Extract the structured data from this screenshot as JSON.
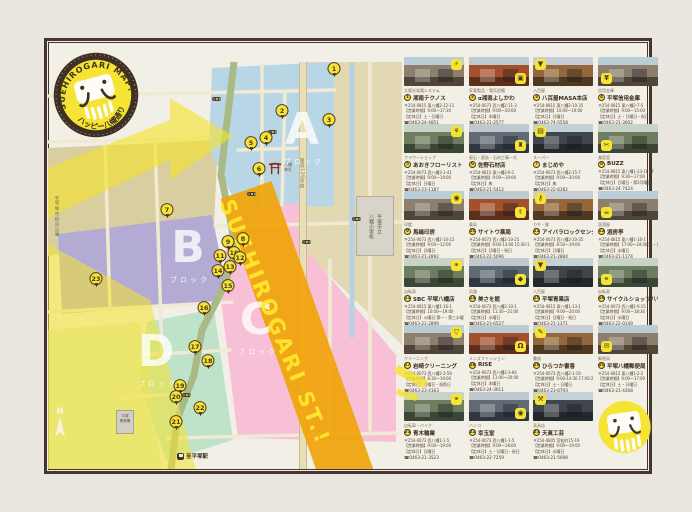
{
  "logo": {
    "arc_top": "SUEHIROGARI MAP!",
    "arc_bottom": "ハッピー八幡通り"
  },
  "map": {
    "blocks": [
      {
        "letter": "A",
        "sub": "ブロック"
      },
      {
        "letter": "B",
        "sub": "ブロック"
      },
      {
        "letter": "C",
        "sub": "ブロック"
      },
      {
        "letter": "D",
        "sub": "ブロック"
      }
    ],
    "street_banner": "SUEHIROGARI ST.!",
    "landmarks": {
      "shrine": "八幡神社",
      "school_line1": "平塚市立",
      "school_line2": "八幡小学校",
      "highway": "国道129号線",
      "to_park": "至平塚市総合公園",
      "to_station": "至平塚駅",
      "police_line1": "平塚",
      "police_line2": "警察署",
      "north": "N"
    }
  },
  "labels": {
    "hours": "【営業時間】",
    "closed": "【定休日】",
    "tel_icon": "☎"
  },
  "shops": [
    {
      "no": 1,
      "category": "太陽光発電システム",
      "name": "湘南テクノス",
      "address": "〒254-0815 東八幡2-12-11",
      "hours": "9:00〜17:30",
      "closed": "土・日曜日",
      "tel": "0463-24-4851",
      "icon": "plug-icon",
      "map_xy": [
        334,
        79
      ]
    },
    {
      "no": 2,
      "category": "家電製品・電気設備",
      "name": "α湘南よしかわ",
      "address": "〒254-0073 西八幡2-11-3",
      "hours": "9:00〜20:00",
      "closed": "木曜日",
      "tel": "0463-21-2577",
      "icon": "tv-icon",
      "map_xy": [
        282,
        121
      ]
    },
    {
      "no": 3,
      "category": "八百屋",
      "name": "八百屋MASA本店",
      "address": "〒254-0815 東八幡2-10-35",
      "hours": "10:00〜19:00",
      "closed": "日曜日",
      "tel": "0463-74-5558",
      "icon": "carrot-icon",
      "map_xy": [
        329,
        130
      ]
    },
    {
      "no": 4,
      "category": "信用金庫",
      "name": "平塚信用金庫",
      "address": "〒254-0815 東八幡2-7-5",
      "hours": "9:00〜15:00",
      "closed": "土・日曜日・祝日",
      "tel": "0463-21-3002",
      "icon": "coin-icon",
      "map_xy": [
        266,
        148
      ]
    },
    {
      "no": 5,
      "category": "フラワーショップ",
      "name": "あおきフローリスト",
      "address": "〒254-0073 西八幡3-1-41",
      "hours": "9:00〜19:00",
      "closed": "日曜日",
      "tel": "0463-23-1187",
      "icon": "flower-icon",
      "map_xy": [
        251,
        153
      ]
    },
    {
      "no": 6,
      "category": "墓石・墓誌・石材工事一式",
      "name": "佐野石材店",
      "address": "〒254-0815 東八幡2-6-1",
      "hours": "9:00〜19:00",
      "closed": "無",
      "tel": "0463-21-5412",
      "icon": "stone-icon",
      "map_xy": [
        259,
        179
      ]
    },
    {
      "no": 7,
      "category": "スーパー",
      "name": "まじめや",
      "address": "〒254-0073 西八幡2-15-7",
      "hours": "9:00〜20:00",
      "closed": "無",
      "tel": "0463-22-6382",
      "icon": "cart-icon",
      "map_xy": [
        167,
        220
      ]
    },
    {
      "no": 8,
      "category": "美容室",
      "name": "BUZZ",
      "address": "〒254-0815 東八幡1-23-16 1F",
      "hours": "9:30〜17:00",
      "closed": "日曜日・第3月曜日",
      "tel": "0463-24-7424",
      "icon": "scissors-icon",
      "map_xy": [
        243,
        249
      ]
    },
    {
      "no": 9,
      "category": "印鑑",
      "name": "馬嶋印房",
      "address": "〒254-0073 西八幡2-10-22",
      "hours": "9:00〜12:00",
      "closed": "日曜日",
      "tel": "0463-21-2892",
      "icon": "stamp-icon",
      "map_xy": [
        228,
        252
      ]
    },
    {
      "no": 10,
      "category": "薬局",
      "name": "サイトウ薬局",
      "address": "〒254-0073 西八幡2-10-25",
      "hours": "9:00-13:00 15:30-18:30",
      "closed": "日曜日・祝日",
      "tel": "0463-22-5096",
      "icon": "medicine-icon",
      "map_xy": [
        234,
        263
      ]
    },
    {
      "no": 11,
      "category": "カギ・錠",
      "name": "アイバラロックセンター",
      "address": "〒254-0073 西八幡2-10-35",
      "hours": "8:50〜19:00",
      "closed": "日曜日",
      "tel": "0463-21-2884",
      "icon": "key-icon",
      "map_xy": [
        220,
        266
      ]
    },
    {
      "no": 12,
      "category": "居酒屋",
      "name": "酒房亭",
      "address": "〒254-0815 東八幡1-16-1",
      "hours": "17:00〜24:00(土・日〜23:00)",
      "closed": "水曜日",
      "tel": "0463-21-1174",
      "icon": "beer-icon",
      "map_xy": [
        240,
        268
      ]
    },
    {
      "no": 13,
      "category": "自転車",
      "name": "SBC 平塚八幡店",
      "address": "〒254-0815 東八幡1-16-1",
      "hours": "10:00〜19:00",
      "closed": "火曜日 第一・第三水曜日",
      "tel": "0463-21-2899",
      "icon": "bicycle-icon",
      "map_xy": [
        230,
        277
      ]
    },
    {
      "no": 14,
      "category": "呉服",
      "name": "美さを館",
      "address": "〒254-0073 西八幡2-10-1",
      "hours": "11:30〜21:00",
      "closed": "水曜日",
      "tel": "0463-23-6527",
      "icon": "cloth-icon",
      "map_xy": [
        218,
        281
      ]
    },
    {
      "no": 15,
      "category": "八百屋",
      "name": "平塚青果店",
      "address": "〒254-0815 東八幡1-13-1",
      "hours": "9:00〜20:00",
      "closed": "日曜日・祝日",
      "tel": "0463-21-1371",
      "icon": "carrot-icon",
      "map_xy": [
        228,
        296
      ]
    },
    {
      "no": 16,
      "category": "自転車",
      "name": "サイクルショップ八千代",
      "address": "〒254-0073 西八幡1-9-15",
      "hours": "9:00〜18:30",
      "closed": "水曜日",
      "tel": "0463-22-0149",
      "icon": "bicycle-icon",
      "map_xy": [
        204,
        318
      ]
    },
    {
      "no": 17,
      "category": "クリーニング",
      "name": "岩崎クリーニング",
      "address": "〒254-0073 西八幡2-3-59",
      "hours": "8:30〜19:00",
      "closed": "日曜日・祝祭日",
      "tel": "0463-23-4163",
      "icon": "shirt-icon",
      "map_xy": [
        195,
        357
      ]
    },
    {
      "no": 18,
      "category": "メンズファッション",
      "name": "RISE",
      "address": "〒254-0073 西八幡2-3-64",
      "hours": "11:00〜20:00",
      "closed": "木曜日",
      "tel": "0463-24-3611",
      "icon": "hanger-icon",
      "map_xy": [
        208,
        371
      ]
    },
    {
      "no": 19,
      "category": "書道",
      "name": "ひらつか書香",
      "address": "〒254-0073 西八幡2-1-19",
      "hours": "9:00-14:30 17:00-20:00",
      "closed": "土・日曜日",
      "tel": "0463-23-6793",
      "icon": "brush-icon",
      "map_xy": [
        180,
        396
      ]
    },
    {
      "no": 20,
      "category": "郵便局",
      "name": "平塚八幡郵便局",
      "address": "〒254-0815 東八幡1-2-2",
      "hours": "9:00〜17:00",
      "closed": "土・日曜日",
      "tel": "0463-21-4308",
      "icon": "envelope-icon",
      "map_xy": [
        176,
        407
      ]
    },
    {
      "no": 21,
      "category": "自転車・バイク",
      "name": "青木輪業",
      "address": "〒254-0073 西八幡1-1-5",
      "hours": "9:00〜19:00",
      "closed": "日曜日",
      "tel": "0463-21-3523",
      "icon": "bicycle-icon",
      "map_xy": [
        176,
        432
      ]
    },
    {
      "no": 22,
      "category": "ハンコ",
      "name": "幸玉堂",
      "address": "〒254-0073 西八幡1-1-5",
      "hours": "9:00〜18:00",
      "closed": "土・日曜日・祝日",
      "tel": "0463-22-7259",
      "icon": "stamp-icon",
      "map_xy": [
        200,
        418
      ]
    },
    {
      "no": 23,
      "category": "表具店",
      "name": "天眞工芸",
      "address": "〒254-0805 宮松町15-19",
      "hours": "9:00〜19:00",
      "closed": "水曜日",
      "tel": "0463-21-5098",
      "icon": "tools-icon",
      "map_xy": [
        96,
        289
      ]
    }
  ]
}
